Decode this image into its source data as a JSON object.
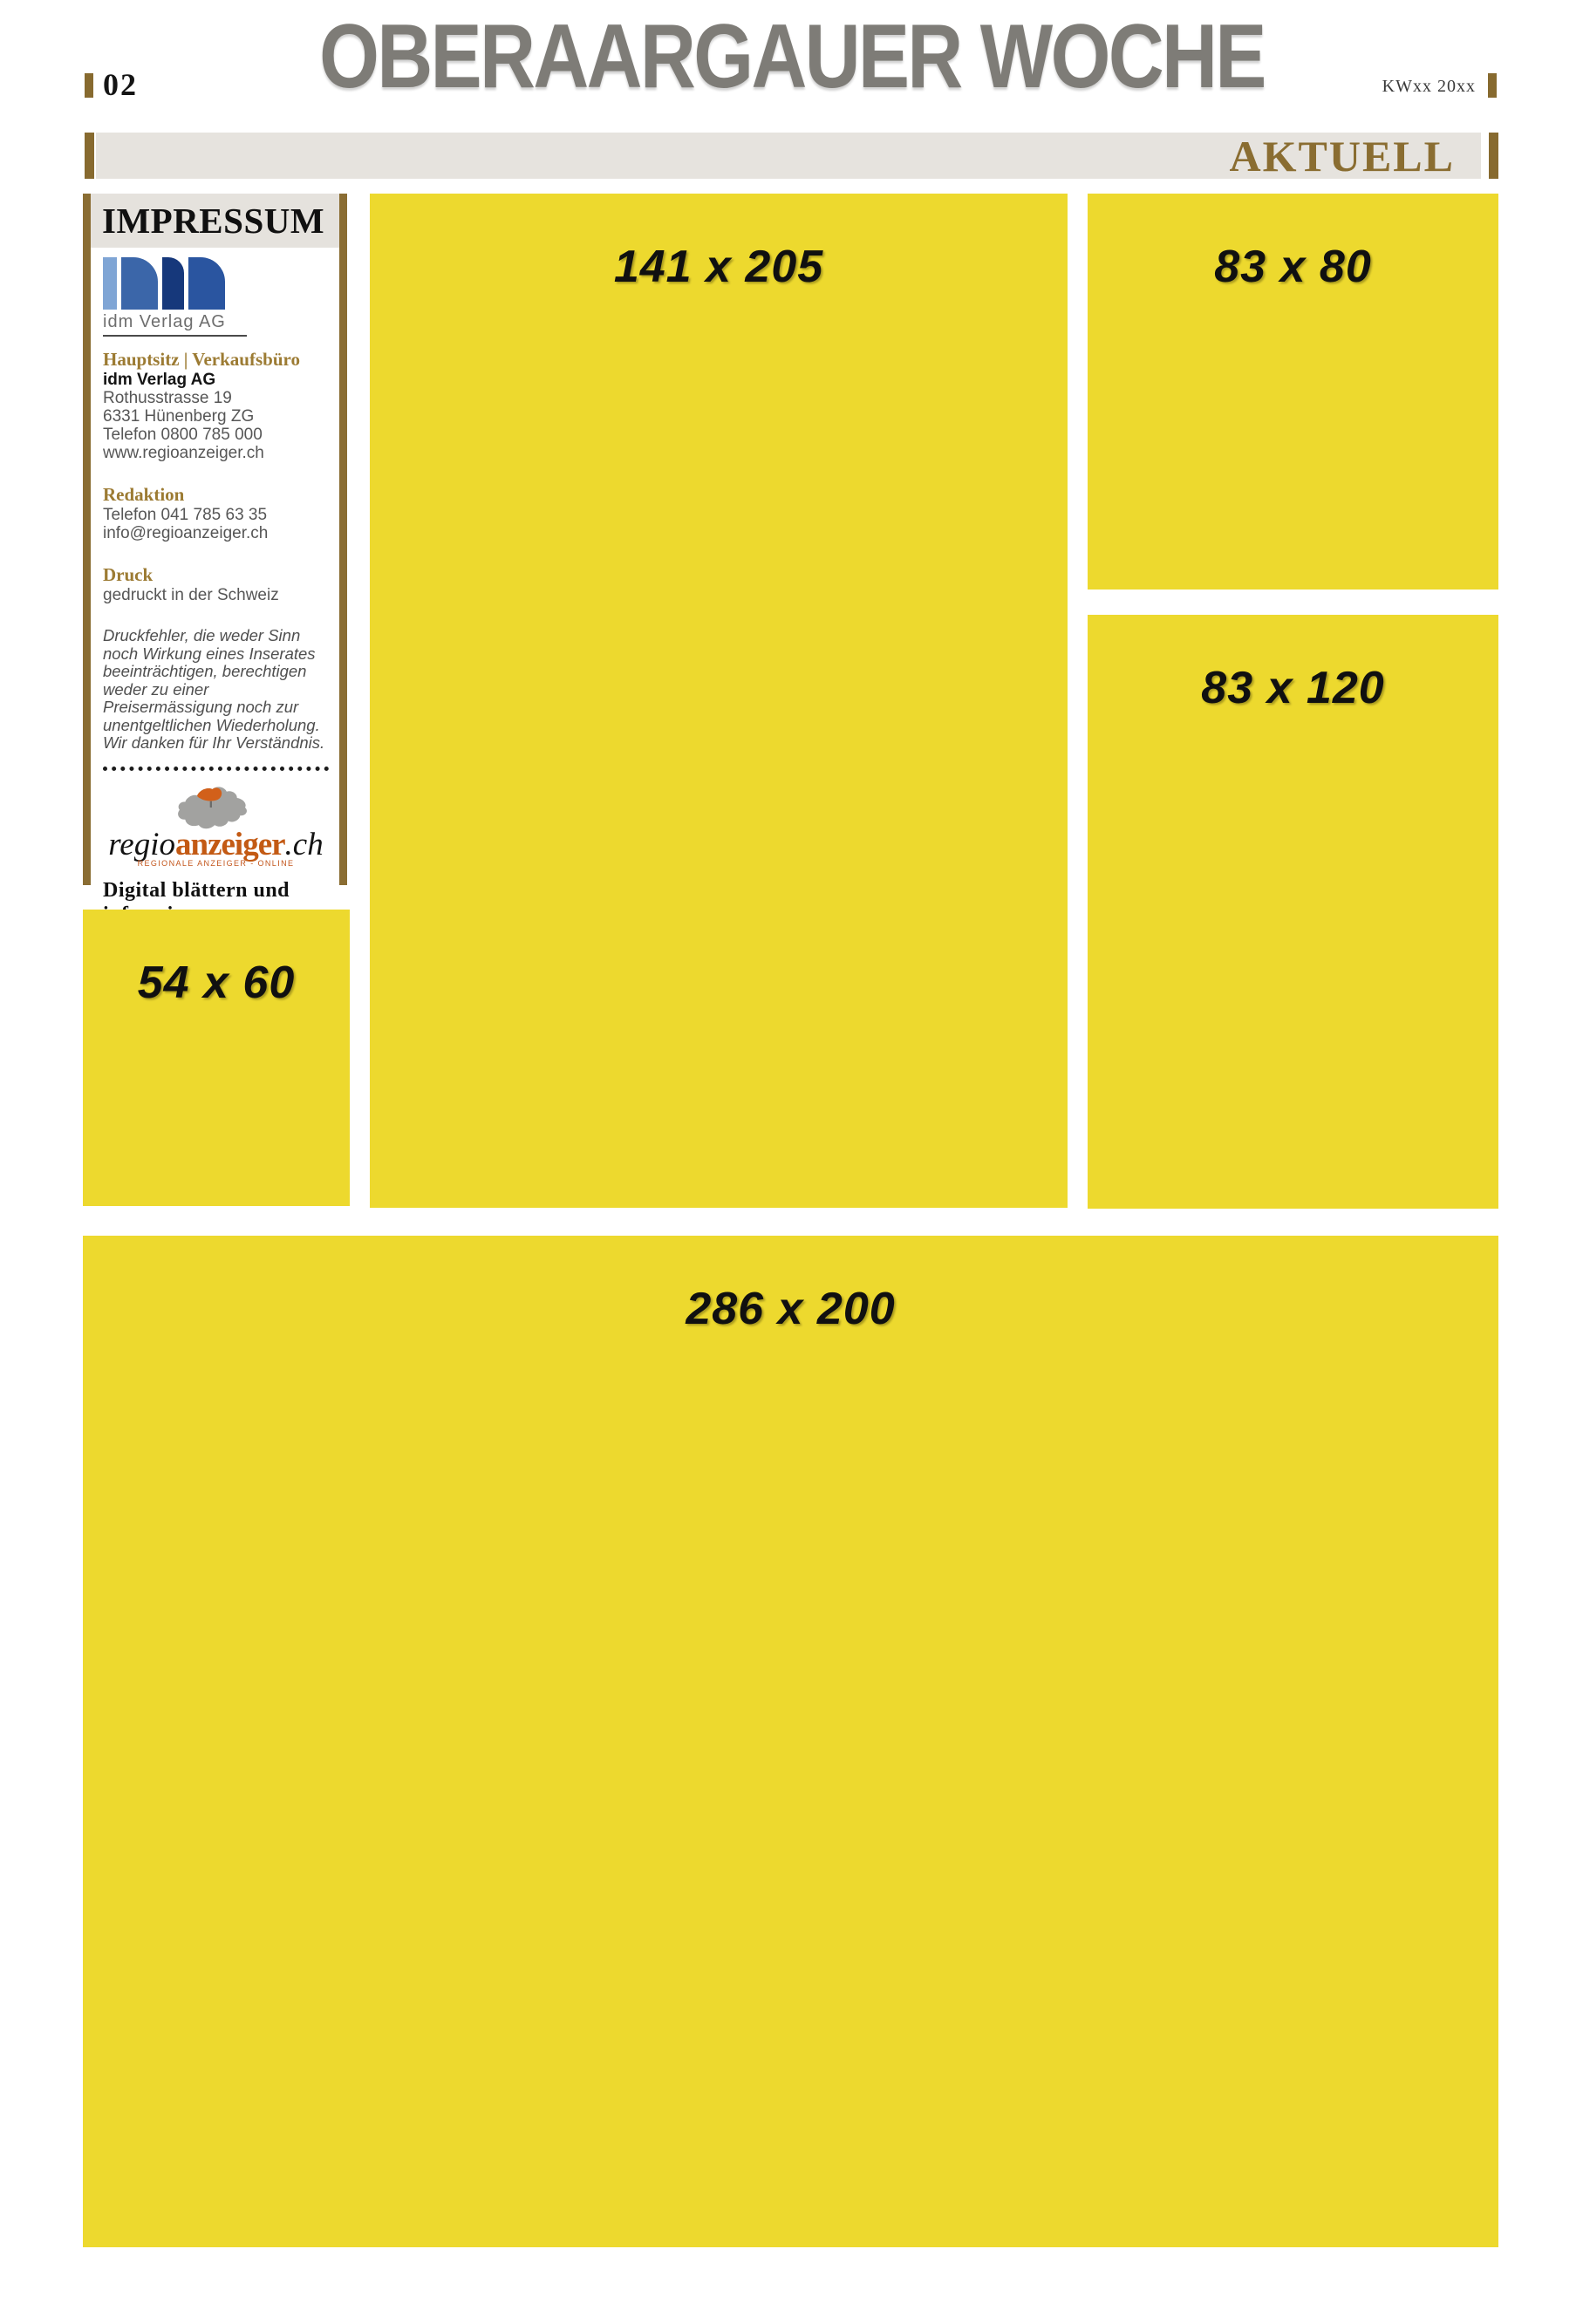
{
  "page": {
    "number": "02",
    "masthead": "OBERAARGAUER WOCHE",
    "issue": "KWxx 20xx",
    "section": "AKTUELL"
  },
  "impressum": {
    "title": "IMPRESSUM",
    "logo_caption": "idm Verlag AG",
    "hauptsitz": {
      "heading": "Hauptsitz | Verkaufsbüro",
      "company": "idm Verlag AG",
      "street": "Rothusstrasse 19",
      "city": "6331 Hünenberg ZG",
      "phone": "Telefon 0800 785 000",
      "web": "www.regioanzeiger.ch"
    },
    "redaktion": {
      "heading": "Redaktion",
      "phone": "Telefon 041 785 63 35",
      "email": "info@regioanzeiger.ch"
    },
    "druck": {
      "heading": "Druck",
      "line": "gedruckt in der Schweiz"
    },
    "disclaimer": "Druckfehler, die weder Sinn noch Wirkung eines Inserates beeinträchtigen, berechtigen weder zu einer Preisermässigung noch zur unentgeltlichen Wiederholung. Wir danken für Ihr Verständnis.",
    "promo": {
      "brand_regio": "regio",
      "brand_anzeiger": "anzeiger",
      "brand_tld": ".ch",
      "subline": "REGIONALE ANZEIGER - ONLINE",
      "tagline": "Digital blättern und informieren"
    }
  },
  "ad_slots": [
    {
      "id": "141x205",
      "label": "141 x 205"
    },
    {
      "id": "83x80",
      "label": "83 x 80"
    },
    {
      "id": "83x120",
      "label": "83 x 120"
    },
    {
      "id": "54x60",
      "label": "54 x 60"
    },
    {
      "id": "286x200",
      "label": "286 x 200"
    }
  ],
  "colors": {
    "ad_yellow": "#EDD92E",
    "accent_gold": "#8A6D31",
    "masthead_gray": "#7E7C77",
    "band_gray": "#E6E3DE",
    "brand_orange": "#C35A14",
    "logo_blue_light": "#7FA5D5",
    "logo_blue_dark": "#16387B"
  }
}
